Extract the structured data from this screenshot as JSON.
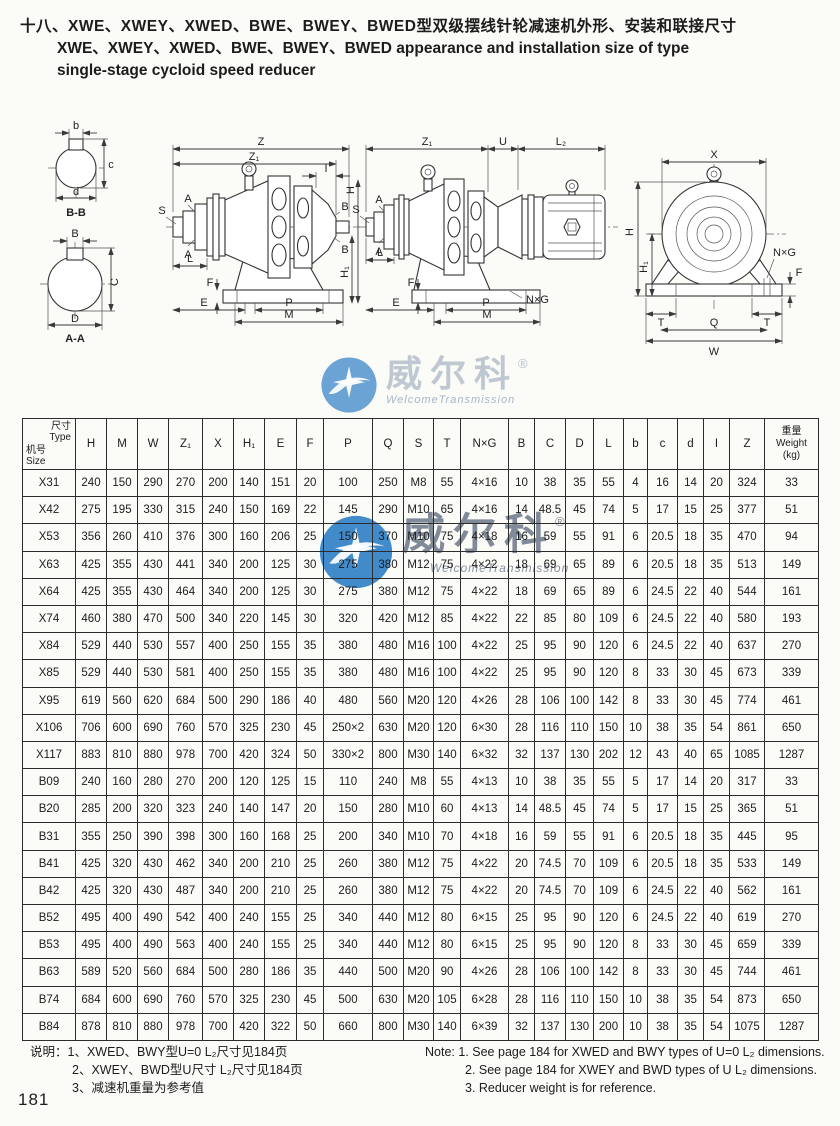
{
  "page": {
    "number": "181",
    "title_zh": "十八、XWE、XWEY、XWED、BWE、BWEY、BWED型双级摆线针轮减速机外形、安装和联接尺寸",
    "title_en_line1": "XWE、XWEY、XWED、BWE、BWEY、BWED appearance and installation size of type",
    "title_en_line2": "single-stage cycloid speed reducer"
  },
  "watermark": {
    "brand": "威尔科",
    "registered": "®",
    "subtext": "WelcomeTransmission"
  },
  "drawings": {
    "labels": {
      "Z": "Z",
      "Z1": "Z₁",
      "I": "I",
      "S": "S",
      "A": "A",
      "L": "L",
      "F": "F",
      "E": "E",
      "P": "P",
      "M": "M",
      "B": "B",
      "H": "H",
      "H1": "H₁",
      "U": "U",
      "L2": "L₂",
      "NxG": "N×G",
      "X": "X",
      "T": "T",
      "Q": "Q",
      "W": "W",
      "b": "b",
      "c": "c",
      "d": "d",
      "C": "C",
      "D": "D",
      "bb": "B-B",
      "aa": "A-A"
    }
  },
  "table": {
    "header": {
      "corner_top_zh": "尺寸",
      "corner_top_en": "Type",
      "corner_bottom_zh": "机号",
      "corner_bottom_en": "Size",
      "columns": [
        "H",
        "M",
        "W",
        "Z₁",
        "X",
        "H₁",
        "E",
        "F",
        "P",
        "Q",
        "S",
        "T",
        "N×G",
        "B",
        "C",
        "D",
        "L",
        "b",
        "c",
        "d",
        "I",
        "Z"
      ],
      "weight_zh": "重量",
      "weight_en": "Weight",
      "weight_unit": "(kg)"
    },
    "rows": [
      {
        "type": "X31",
        "values": [
          "240",
          "150",
          "290",
          "270",
          "200",
          "140",
          "151",
          "20",
          "100",
          "250",
          "M8",
          "55",
          "4×16",
          "10",
          "38",
          "35",
          "55",
          "4",
          "16",
          "14",
          "20",
          "324",
          "33"
        ]
      },
      {
        "type": "X42",
        "values": [
          "275",
          "195",
          "330",
          "315",
          "240",
          "150",
          "169",
          "22",
          "145",
          "290",
          "M10",
          "65",
          "4×16",
          "14",
          "48.5",
          "45",
          "74",
          "5",
          "17",
          "15",
          "25",
          "377",
          "51"
        ]
      },
      {
        "type": "X53",
        "values": [
          "356",
          "260",
          "410",
          "376",
          "300",
          "160",
          "206",
          "25",
          "150",
          "370",
          "M10",
          "75",
          "4×18",
          "16",
          "59",
          "55",
          "91",
          "6",
          "20.5",
          "18",
          "35",
          "470",
          "94"
        ]
      },
      {
        "type": "X63",
        "values": [
          "425",
          "355",
          "430",
          "441",
          "340",
          "200",
          "125",
          "30",
          "275",
          "380",
          "M12",
          "75",
          "4×22",
          "18",
          "69",
          "65",
          "89",
          "6",
          "20.5",
          "18",
          "35",
          "513",
          "149"
        ]
      },
      {
        "type": "X64",
        "values": [
          "425",
          "355",
          "430",
          "464",
          "340",
          "200",
          "125",
          "30",
          "275",
          "380",
          "M12",
          "75",
          "4×22",
          "18",
          "69",
          "65",
          "89",
          "6",
          "24.5",
          "22",
          "40",
          "544",
          "161"
        ]
      },
      {
        "type": "X74",
        "values": [
          "460",
          "380",
          "470",
          "500",
          "340",
          "220",
          "145",
          "30",
          "320",
          "420",
          "M12",
          "85",
          "4×22",
          "22",
          "85",
          "80",
          "109",
          "6",
          "24.5",
          "22",
          "40",
          "580",
          "193"
        ]
      },
      {
        "type": "X84",
        "values": [
          "529",
          "440",
          "530",
          "557",
          "400",
          "250",
          "155",
          "35",
          "380",
          "480",
          "M16",
          "100",
          "4×22",
          "25",
          "95",
          "90",
          "120",
          "6",
          "24.5",
          "22",
          "40",
          "637",
          "270"
        ]
      },
      {
        "type": "X85",
        "values": [
          "529",
          "440",
          "530",
          "581",
          "400",
          "250",
          "155",
          "35",
          "380",
          "480",
          "M16",
          "100",
          "4×22",
          "25",
          "95",
          "90",
          "120",
          "8",
          "33",
          "30",
          "45",
          "673",
          "339"
        ]
      },
      {
        "type": "X95",
        "values": [
          "619",
          "560",
          "620",
          "684",
          "500",
          "290",
          "186",
          "40",
          "480",
          "560",
          "M20",
          "120",
          "4×26",
          "28",
          "106",
          "100",
          "142",
          "8",
          "33",
          "30",
          "45",
          "774",
          "461"
        ]
      },
      {
        "type": "X106",
        "values": [
          "706",
          "600",
          "690",
          "760",
          "570",
          "325",
          "230",
          "45",
          "250×2",
          "630",
          "M20",
          "120",
          "6×30",
          "28",
          "116",
          "110",
          "150",
          "10",
          "38",
          "35",
          "54",
          "861",
          "650"
        ]
      },
      {
        "type": "X117",
        "values": [
          "883",
          "810",
          "880",
          "978",
          "700",
          "420",
          "324",
          "50",
          "330×2",
          "800",
          "M30",
          "140",
          "6×32",
          "32",
          "137",
          "130",
          "202",
          "12",
          "43",
          "40",
          "65",
          "1085",
          "1287"
        ]
      },
      {
        "type": "B09",
        "values": [
          "240",
          "160",
          "280",
          "270",
          "200",
          "120",
          "125",
          "15",
          "110",
          "240",
          "M8",
          "55",
          "4×13",
          "10",
          "38",
          "35",
          "55",
          "5",
          "17",
          "14",
          "20",
          "317",
          "33"
        ]
      },
      {
        "type": "B20",
        "values": [
          "285",
          "200",
          "320",
          "323",
          "240",
          "140",
          "147",
          "20",
          "150",
          "280",
          "M10",
          "60",
          "4×13",
          "14",
          "48.5",
          "45",
          "74",
          "5",
          "17",
          "15",
          "25",
          "365",
          "51"
        ]
      },
      {
        "type": "B31",
        "values": [
          "355",
          "250",
          "390",
          "398",
          "300",
          "160",
          "168",
          "25",
          "200",
          "340",
          "M10",
          "70",
          "4×18",
          "16",
          "59",
          "55",
          "91",
          "6",
          "20.5",
          "18",
          "35",
          "445",
          "95"
        ]
      },
      {
        "type": "B41",
        "values": [
          "425",
          "320",
          "430",
          "462",
          "340",
          "200",
          "210",
          "25",
          "260",
          "380",
          "M12",
          "75",
          "4×22",
          "20",
          "74.5",
          "70",
          "109",
          "6",
          "20.5",
          "18",
          "35",
          "533",
          "149"
        ]
      },
      {
        "type": "B42",
        "values": [
          "425",
          "320",
          "430",
          "487",
          "340",
          "200",
          "210",
          "25",
          "260",
          "380",
          "M12",
          "75",
          "4×22",
          "20",
          "74.5",
          "70",
          "109",
          "6",
          "24.5",
          "22",
          "40",
          "562",
          "161"
        ]
      },
      {
        "type": "B52",
        "values": [
          "495",
          "400",
          "490",
          "542",
          "400",
          "240",
          "155",
          "25",
          "340",
          "440",
          "M12",
          "80",
          "6×15",
          "25",
          "95",
          "90",
          "120",
          "6",
          "24.5",
          "22",
          "40",
          "619",
          "270"
        ]
      },
      {
        "type": "B53",
        "values": [
          "495",
          "400",
          "490",
          "563",
          "400",
          "240",
          "155",
          "25",
          "340",
          "440",
          "M12",
          "80",
          "6×15",
          "25",
          "95",
          "90",
          "120",
          "8",
          "33",
          "30",
          "45",
          "659",
          "339"
        ]
      },
      {
        "type": "B63",
        "values": [
          "589",
          "520",
          "560",
          "684",
          "500",
          "280",
          "186",
          "35",
          "440",
          "500",
          "M20",
          "90",
          "4×26",
          "28",
          "106",
          "100",
          "142",
          "8",
          "33",
          "30",
          "45",
          "744",
          "461"
        ]
      },
      {
        "type": "B74",
        "values": [
          "684",
          "600",
          "690",
          "760",
          "570",
          "325",
          "230",
          "45",
          "500",
          "630",
          "M20",
          "105",
          "6×28",
          "28",
          "116",
          "110",
          "150",
          "10",
          "38",
          "35",
          "54",
          "873",
          "650"
        ]
      },
      {
        "type": "B84",
        "values": [
          "878",
          "810",
          "880",
          "978",
          "700",
          "420",
          "322",
          "50",
          "660",
          "800",
          "M30",
          "140",
          "6×39",
          "32",
          "137",
          "130",
          "200",
          "10",
          "38",
          "35",
          "54",
          "1075",
          "1287"
        ]
      }
    ]
  },
  "notes_zh": {
    "label": "说明：",
    "items": [
      "1、XWED、BWY型U=0 L₂尺寸见184页",
      "2、XWEY、BWD型U尺寸 L₂尺寸见184页",
      "3、减速机重量为参考值"
    ]
  },
  "notes_en": {
    "label": "Note:",
    "items": [
      "1. See page 184 for XWED and BWY types of U=0 L₂ dimensions.",
      "2. See page 184 for XWEY and BWD types of U L₂ dimensions.",
      "3. Reducer weight is for reference."
    ]
  }
}
